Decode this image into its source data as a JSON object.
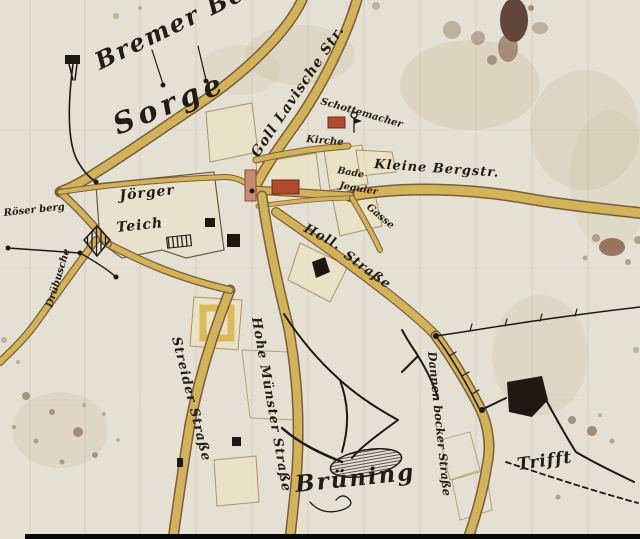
{
  "meta": {
    "title": "Historical hand-drawn town map, old German Kurrent script, aged paper with ink roads and stains"
  },
  "labels": {
    "bremer_berge": "Bremer Berge",
    "sorge": "Sorge",
    "goll_lavische": "Goll Lavische Str.",
    "schottemacher": "Schottemacher",
    "kirche": "Kirche",
    "kleine_bergstr": "Kleine Bergstr.",
    "bade": "Bade",
    "jequier": "Jequier",
    "gasse": "Gasse",
    "holl": "Holl.",
    "holl_strasse": "Straße",
    "joerger": "Jörger",
    "teich": "Teich",
    "roeser_berg": "Röser berg",
    "druebusche": "Drübusche",
    "streider_strasse": "Streider Straße",
    "hohe_muenster_strasse": "Hohe Münster Straße",
    "dannenbocker_strasse": "Dannen bocker Straße",
    "bruening": "Brüning",
    "trifft": "Trifft"
  },
  "colors": {
    "paper": "#e4e0d3",
    "road_fill": "#d9bb5c",
    "road_edge": "#7b5d3b",
    "ink": "#1f1812",
    "building_red": "#b04a30",
    "building_pink": "#c68a70",
    "stain_brown": "#6b4226"
  },
  "features": {
    "pond_label": "Jörger Teich (pond)",
    "mill_symbol": "hatched diamond mill symbol",
    "gallows_symbol": "black post marker on hill",
    "church_symbol": "flag-and-circle church symbol",
    "bruening_mound": "hatched oval mound near Brüning",
    "trift_path": "dashed drover's path near Trifft"
  }
}
